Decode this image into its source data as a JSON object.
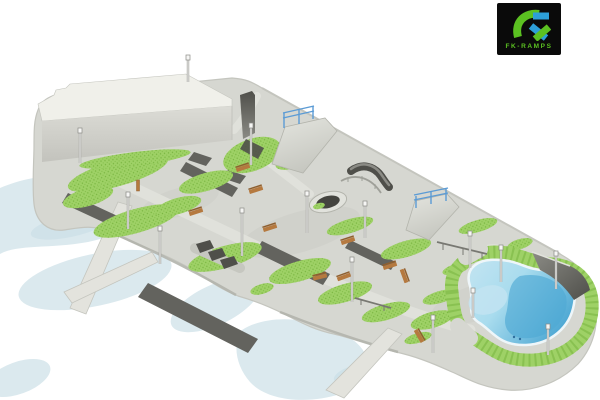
{
  "logo": {
    "monogram": "FK",
    "wordmark": "FK-RAMPS"
  },
  "scene": {
    "description": "Isometric 3D rendering of a skatepark design: large white building, concrete plaza with grass islands, asphalt strips, quarter pipes and bank ramps with blue railings, grind rails, ledges, rhythm humps, round fire pit, wooden benches, street lamps, kidney-shaped blue pool bowl ringed by grass, footbridges over a pale river",
    "inventory": [
      "building",
      "concrete-plaza",
      "grass-island",
      "asphalt-path",
      "river",
      "footbridge",
      "kidney-pool",
      "pool-grass-ring",
      "quarter-pipe",
      "bank-ramp-with-railing",
      "wallride-wall",
      "curved-ledge",
      "curved-grind-rail",
      "flat-grind-rail",
      "rhythm-humps",
      "round-fire-pit",
      "wooden-bench",
      "trash-bin",
      "street-lamp"
    ]
  },
  "colors": {
    "background": "#ffffff",
    "water": "#dbe9ee",
    "water_deep": "#c7dde6",
    "concrete": "#d6d7d1",
    "concrete_light": "#e1e2dc",
    "concrete_shade": "#c6c7c0",
    "park_edge": "#b3b4ac",
    "edge_light": "#c4c5be",
    "asphalt": "#63635e",
    "grass": "#9ed166",
    "grass_dark": "#79b540",
    "building_roof": "#f0f0ea",
    "building_wall": "#dcdcd6",
    "building_wall_dark": "#c3c3bd",
    "ramp_light": "#e4e5df",
    "ramp_mid": "#8b8b85",
    "ramp_dark": "#4f4f4a",
    "rail_blue": "#5b9bd5",
    "rail_gray": "#9fa099",
    "pool_rim": "#c3e4f1",
    "pool_shallow": "#a9dcee",
    "pool_deep": "#4fa9d4",
    "pool_coping": "#eef6f9",
    "bench_wood": "#b5793f",
    "bench_dark": "#8f5f2f",
    "lamp_pole": "#9e9e9a",
    "lamp_white": "#f6f6f4",
    "bridge": "#e3e3dd",
    "logo_bg": "#0a0a0a",
    "logo_green": "#5bc121",
    "logo_blue": "#2d9fd8"
  }
}
